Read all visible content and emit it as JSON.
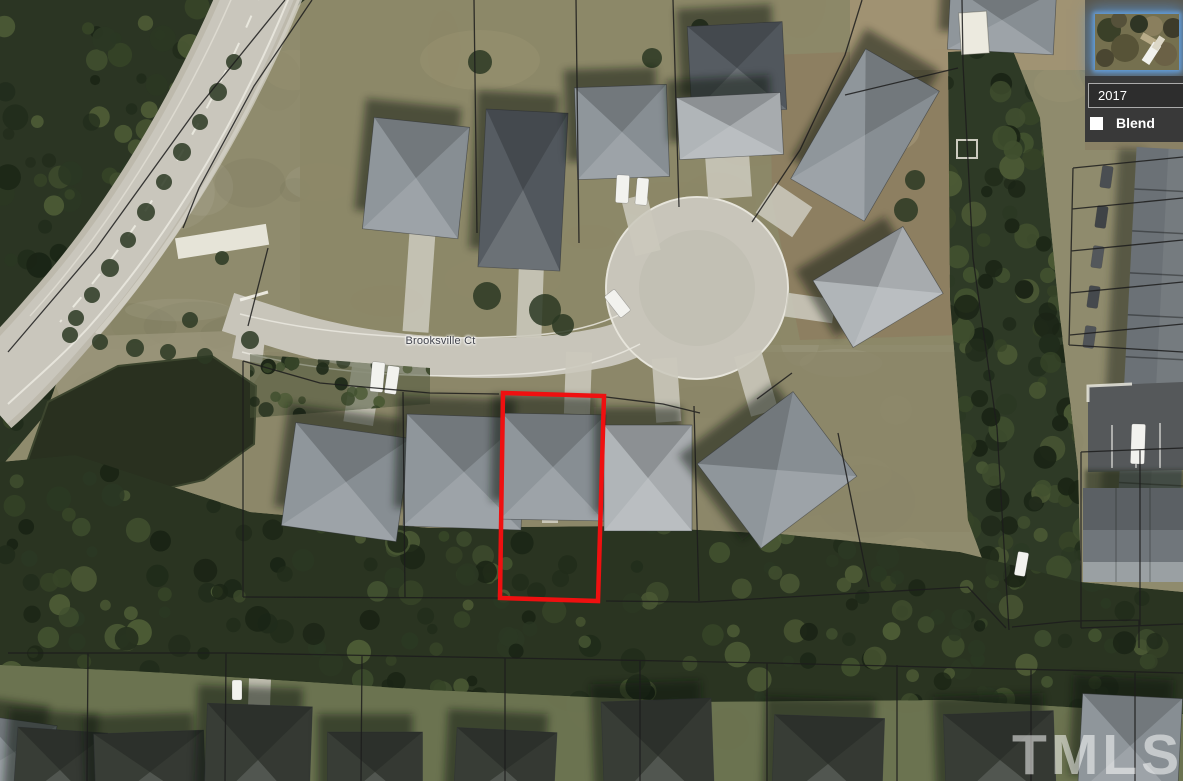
{
  "map": {
    "street_label": "Brooksville Ct",
    "selected_parcel": {
      "outline_color": "#ef1010"
    },
    "parcel_line_color": "#1c1c1c"
  },
  "layers_panel": {
    "year_value": "2017",
    "blend": {
      "label": "Blend",
      "checked": false
    },
    "thumbnail": {
      "name": "aerial-layer-thumbnail-2017",
      "selected": true,
      "glow_color": "#5b9bd5"
    },
    "background_color": "#3a3a3a"
  },
  "watermark": {
    "text": "TMLS"
  }
}
